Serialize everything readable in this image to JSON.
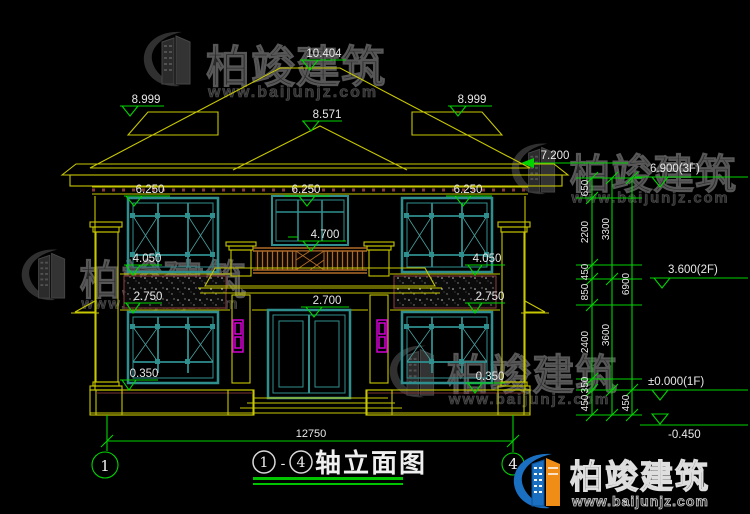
{
  "drawing": {
    "title": {
      "axis_start": "1",
      "separator": "-",
      "axis_end": "4",
      "name": "轴立面图"
    },
    "grid_axes": {
      "left": "1",
      "right": "4"
    },
    "overall_width_dim": "12750",
    "levels": {
      "ridge": "10.404",
      "side_eave_left": "8.999",
      "side_eave_right": "8.999",
      "gable": "8.571",
      "main_eave": "7.200",
      "floor3": "6.900(3F)",
      "eave_bottom_left": "6.250",
      "eave_bottom_center": "6.250",
      "eave_bottom_right": "6.250",
      "balcony_rail": "4.700",
      "sill2_left": "4.050",
      "sill2_right": "4.050",
      "floor2": "3.600(2F)",
      "lintel1_left": "2.750",
      "lintel1_right": "2.750",
      "door_head": "2.700",
      "sill1_left": "0.350",
      "sill1_right": "0.350",
      "floor1": "±0.000(1F)",
      "ground": "-0.450"
    },
    "chain_col1": [
      "650",
      "2200",
      "450",
      "850",
      "2400",
      "350",
      "450"
    ],
    "chain_col2": [
      "3300",
      "3600"
    ],
    "chain_col3": [
      "6900",
      "450"
    ]
  },
  "watermark": {
    "brand": "柏竣建筑",
    "url": "www.baijunjz.com"
  },
  "logo": {
    "brand": "柏竣建筑",
    "url": "www.baijunjz.com"
  },
  "colors": {
    "background": "#000000",
    "line_yellow": "#c8c800",
    "line_green": "#00d400",
    "window_teal": "#2f8f8f",
    "accent_magenta": "#e000e0",
    "wood_orange": "#b06a28",
    "text_white": "#e8e8e8",
    "logo_blue": "#1a6fc0",
    "logo_orange": "#ef8d16"
  }
}
